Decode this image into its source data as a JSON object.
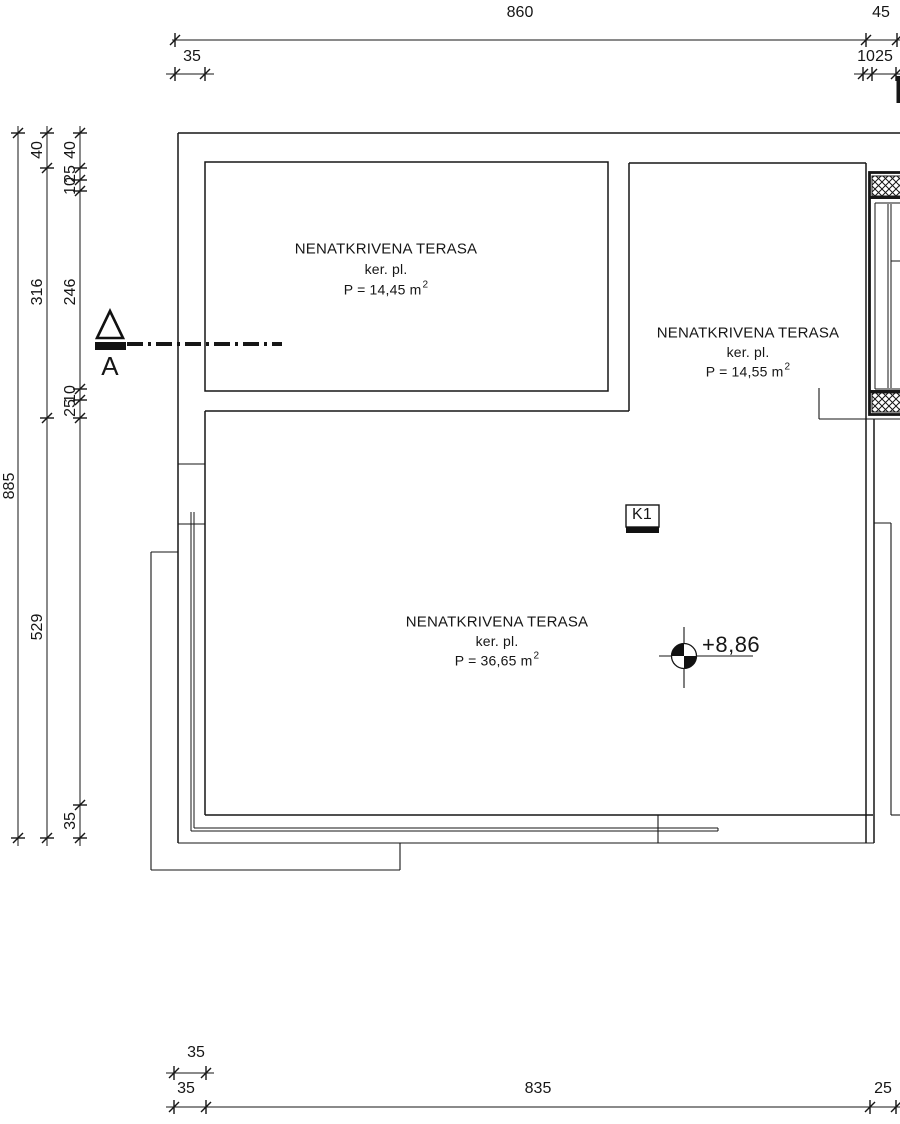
{
  "rooms": [
    {
      "name": "NENATKRIVENA TERASA",
      "finish": "ker. pl.",
      "area": "P = 14,45 m",
      "area_sup": "2"
    },
    {
      "name": "NENATKRIVENA TERASA",
      "finish": "ker. pl.",
      "area": "P = 14,55 m",
      "area_sup": "2"
    },
    {
      "name": "NENATKRIVENA TERASA",
      "finish": "ker. pl.",
      "area": "P = 36,65 m",
      "area_sup": "2"
    }
  ],
  "markers": {
    "section": "A",
    "beam": "K1",
    "elevation": "+8,86"
  },
  "dims": {
    "top": {
      "total": "860",
      "right": "45",
      "left_sub": "35",
      "right_sub_a": "10",
      "right_sub_b": "25"
    },
    "left": {
      "total": "885",
      "mid": [
        "40",
        "316",
        "529"
      ],
      "inner": [
        "40",
        "25",
        "10",
        "246",
        "10",
        "25",
        "35"
      ]
    },
    "bottom": {
      "upper": "35",
      "lower_left": "35",
      "lower_mid": "835",
      "lower_right": "25"
    }
  },
  "colors": {
    "line": "#1c1c1c",
    "bg": "#ffffff"
  }
}
